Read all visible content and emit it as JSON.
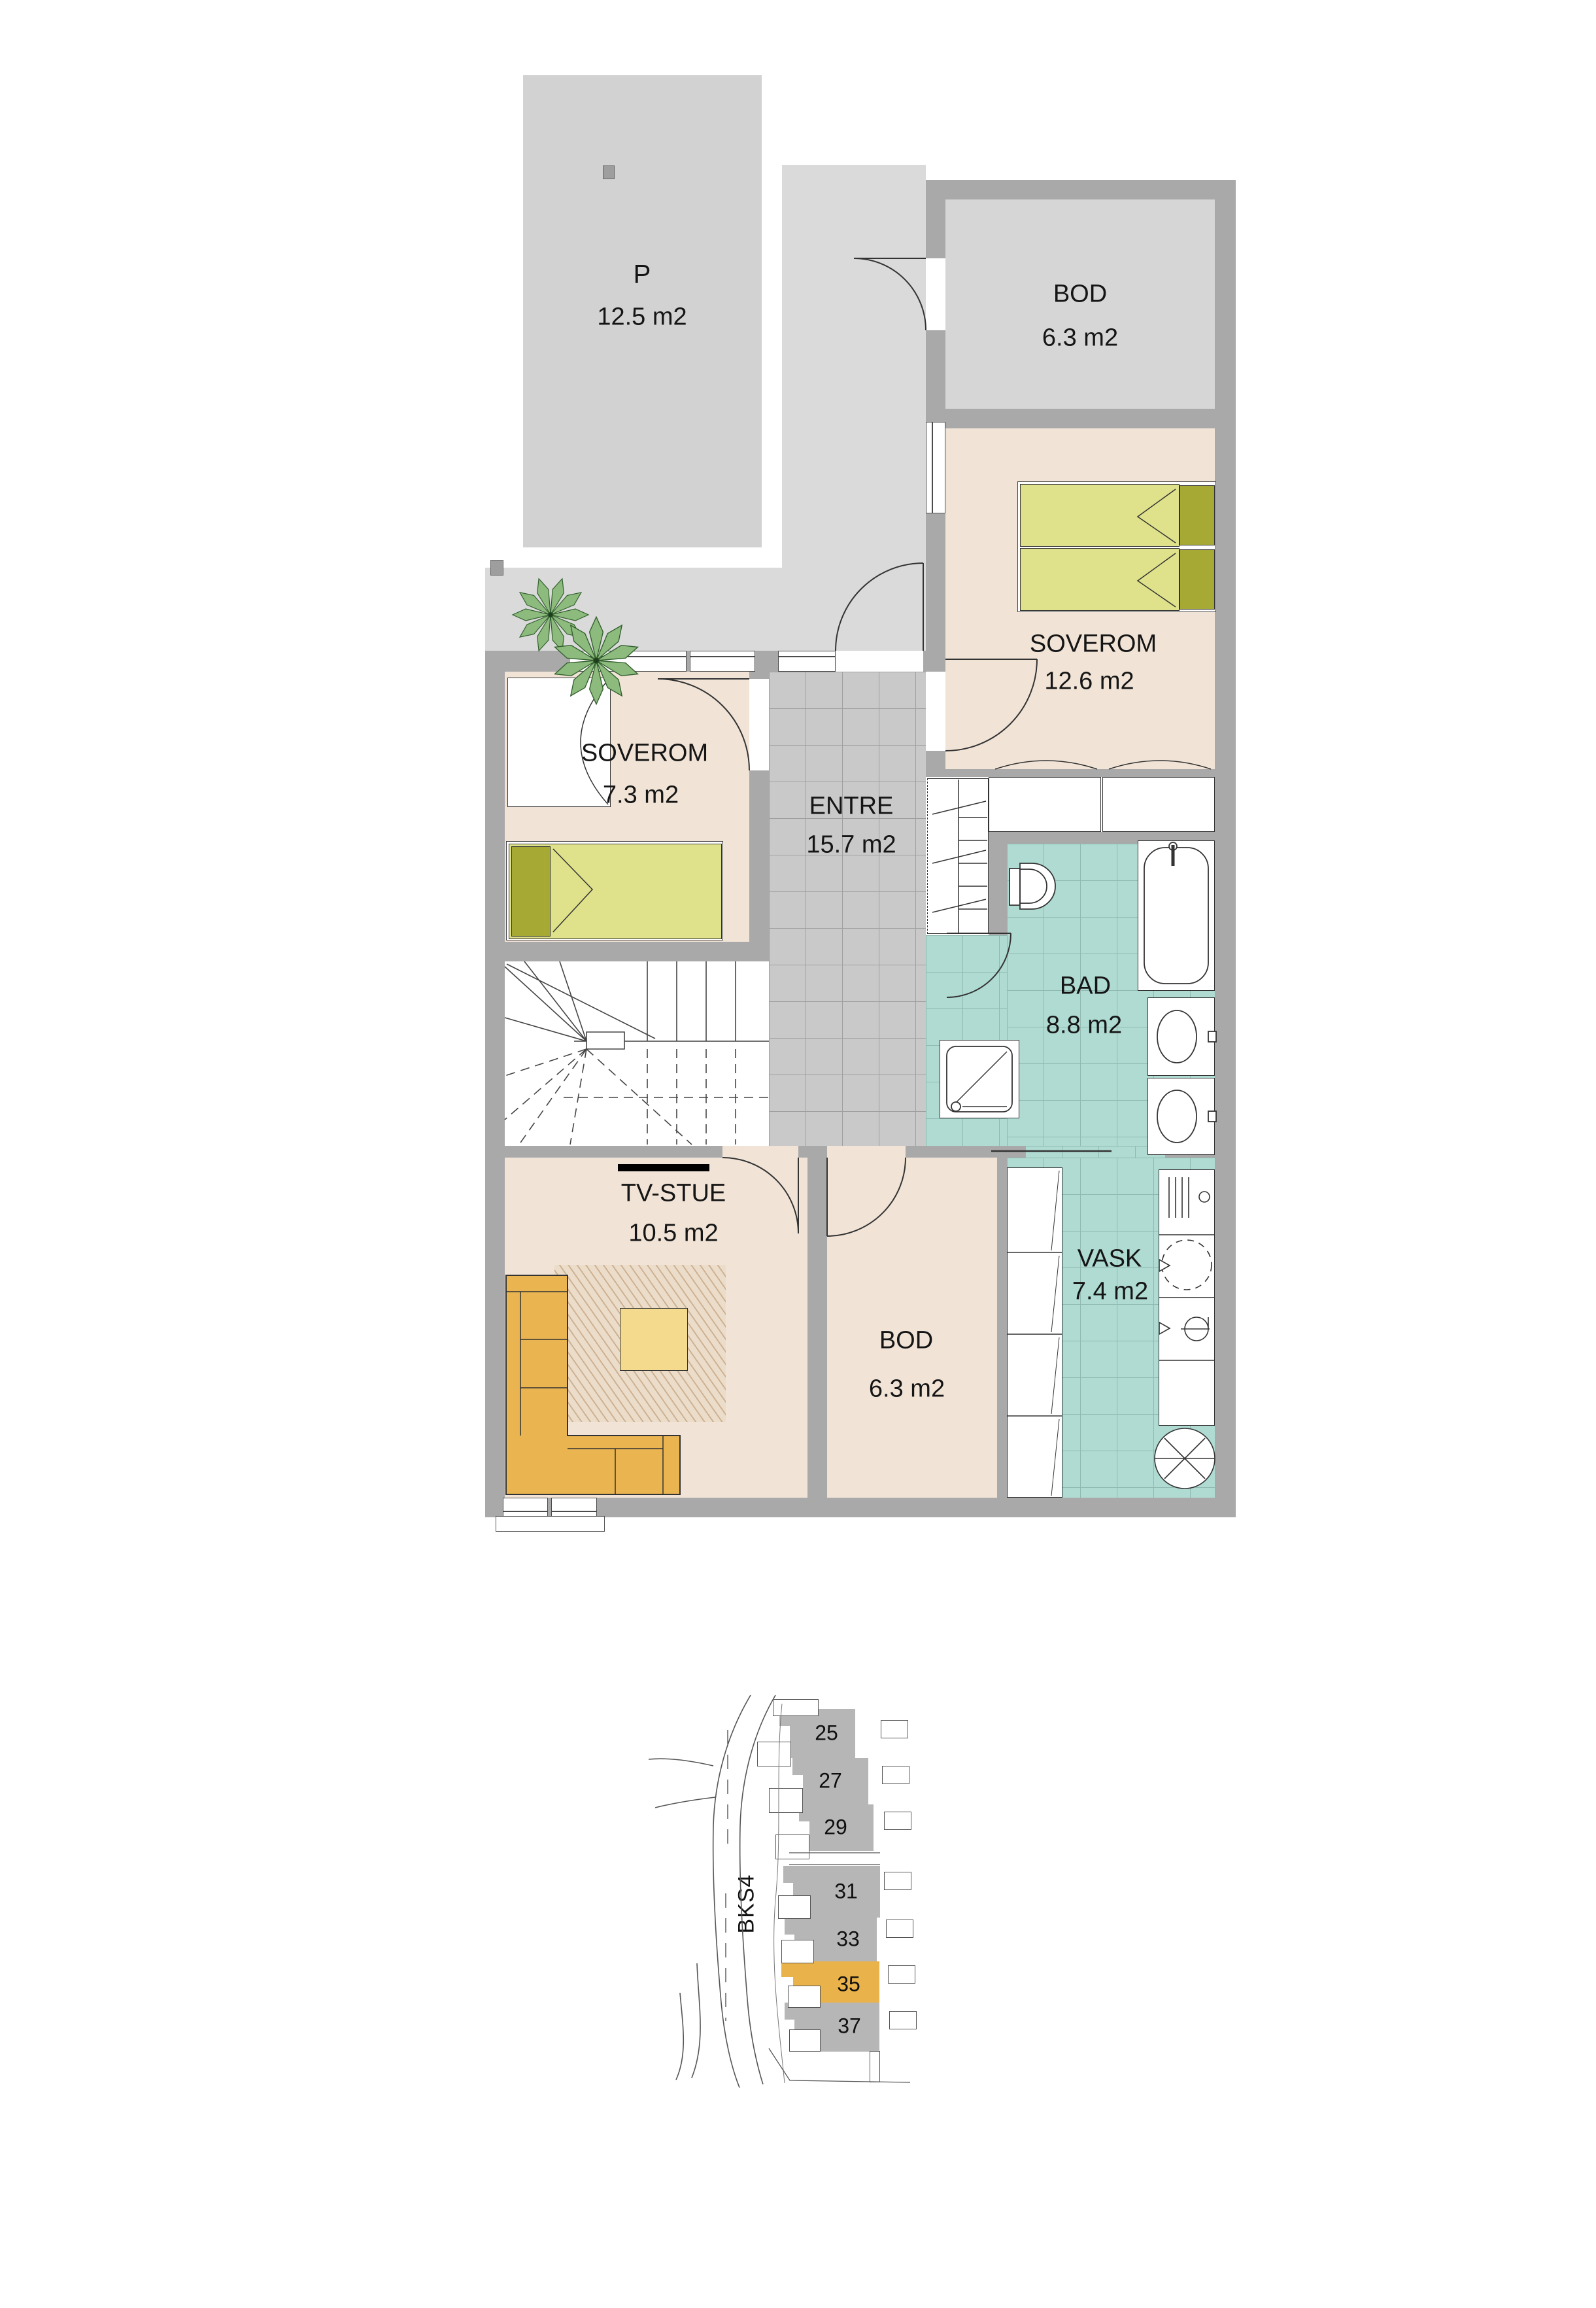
{
  "plan": {
    "parking": {
      "name": "P",
      "area": "12.5 m2"
    },
    "rooms": [
      {
        "id": "bod-upper",
        "name": "BOD",
        "area": "6.3 m2"
      },
      {
        "id": "soverom-main",
        "name": "SOVEROM",
        "area": "12.6 m2"
      },
      {
        "id": "soverom-small",
        "name": "SOVEROM",
        "area": "7.3 m2"
      },
      {
        "id": "entre",
        "name": "ENTRE",
        "area": "15.7 m2"
      },
      {
        "id": "bad",
        "name": "BAD",
        "area": "8.8 m2"
      },
      {
        "id": "tv-stue",
        "name": "TV-STUE",
        "area": "10.5 m2"
      },
      {
        "id": "bod-lower",
        "name": "BOD",
        "area": "6.3 m2"
      },
      {
        "id": "vask",
        "name": "VASK",
        "area": "7.4 m2"
      }
    ],
    "furniture": [
      "double-bed",
      "single-bed",
      "wardrobe",
      "entre-closet",
      "stairs",
      "bathtub",
      "toilet",
      "shower",
      "double-sink",
      "washing-machine",
      "dryer",
      "laundry-sink",
      "floor-drain",
      "corner-sofa",
      "coffee-table",
      "rug",
      "tv",
      "plant"
    ]
  },
  "site_map": {
    "road_label": "BKS4",
    "units": [
      "25",
      "27",
      "29",
      "31",
      "33",
      "35",
      "37"
    ],
    "highlighted_unit": "35",
    "highlight_color": "#e9b24a"
  },
  "colors": {
    "wall": "#a9a9a9",
    "floor_room": "#f1e4d7",
    "floor_tile_gray": "#c9c9c9",
    "floor_wet_teal": "#afdbd2",
    "outdoor_gray": "#d8d8d8",
    "bed_green": "#dfe28b",
    "pillow_olive": "#a6aa35",
    "sofa_orange": "#eab551",
    "table_yellow": "#f3da8d",
    "site_building_gray": "#b6b6b6"
  }
}
